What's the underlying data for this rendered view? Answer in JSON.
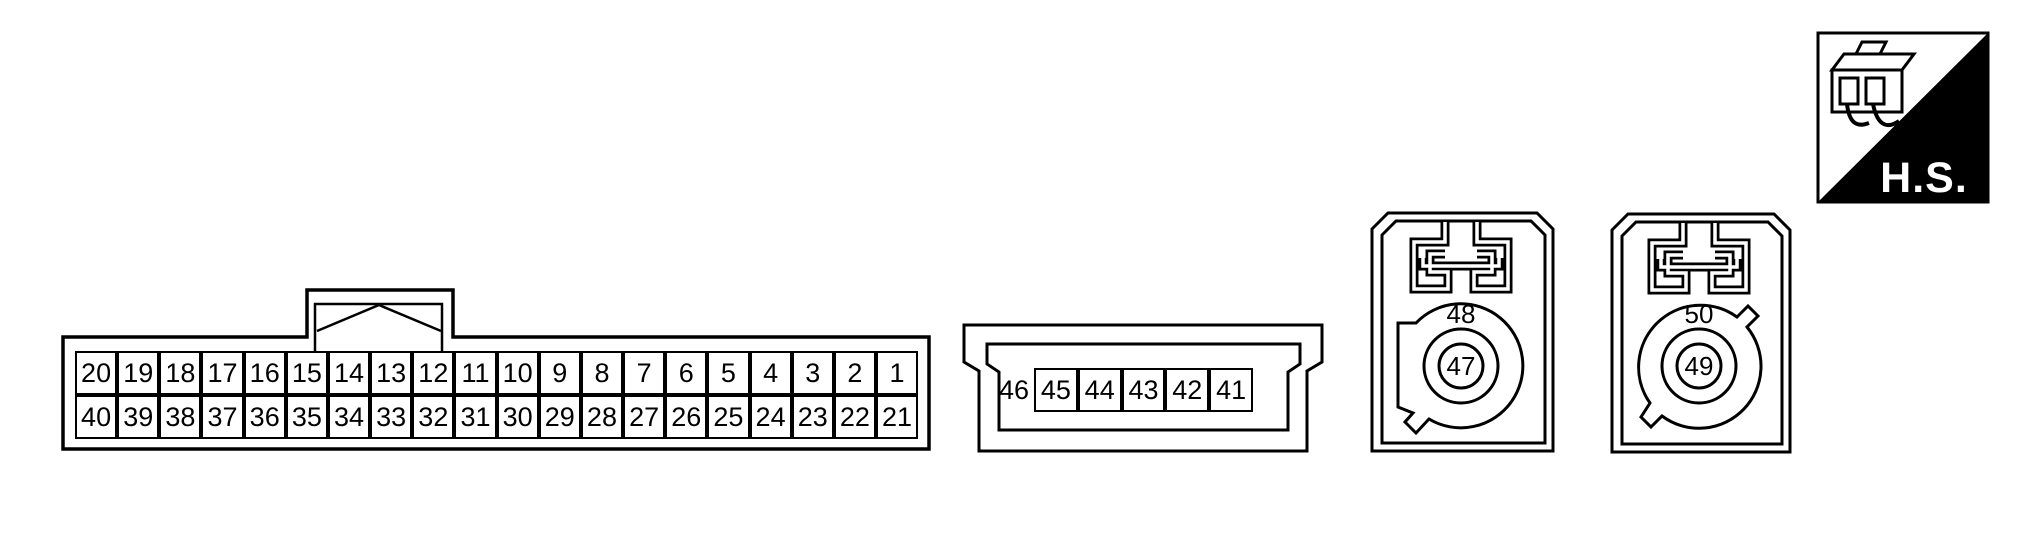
{
  "diagram": {
    "background": "#ffffff",
    "line_color": "#000000",
    "kind": "wiring-harness-connector-pinouts"
  },
  "hs_badge": {
    "label": "H.S.",
    "icon": "connector-plug-icon",
    "triangle_color": "#000000",
    "text_color": "#ffffff"
  },
  "connectors": {
    "main_40pin": {
      "top_row": [
        "20",
        "19",
        "18",
        "17",
        "16",
        "15",
        "14",
        "13",
        "12",
        "11",
        "10",
        "9",
        "8",
        "7",
        "6",
        "5",
        "4",
        "3",
        "2",
        "1"
      ],
      "bottom_row": [
        "40",
        "39",
        "38",
        "37",
        "36",
        "35",
        "34",
        "33",
        "32",
        "31",
        "30",
        "29",
        "28",
        "27",
        "26",
        "25",
        "24",
        "23",
        "22",
        "21"
      ]
    },
    "mid_6pin": {
      "outside_label": "46",
      "cells": [
        "45",
        "44",
        "43",
        "42",
        "41"
      ]
    },
    "round_left": {
      "rim_label": "48",
      "center_label": "47"
    },
    "round_right": {
      "rim_label": "50",
      "center_label": "49"
    }
  }
}
